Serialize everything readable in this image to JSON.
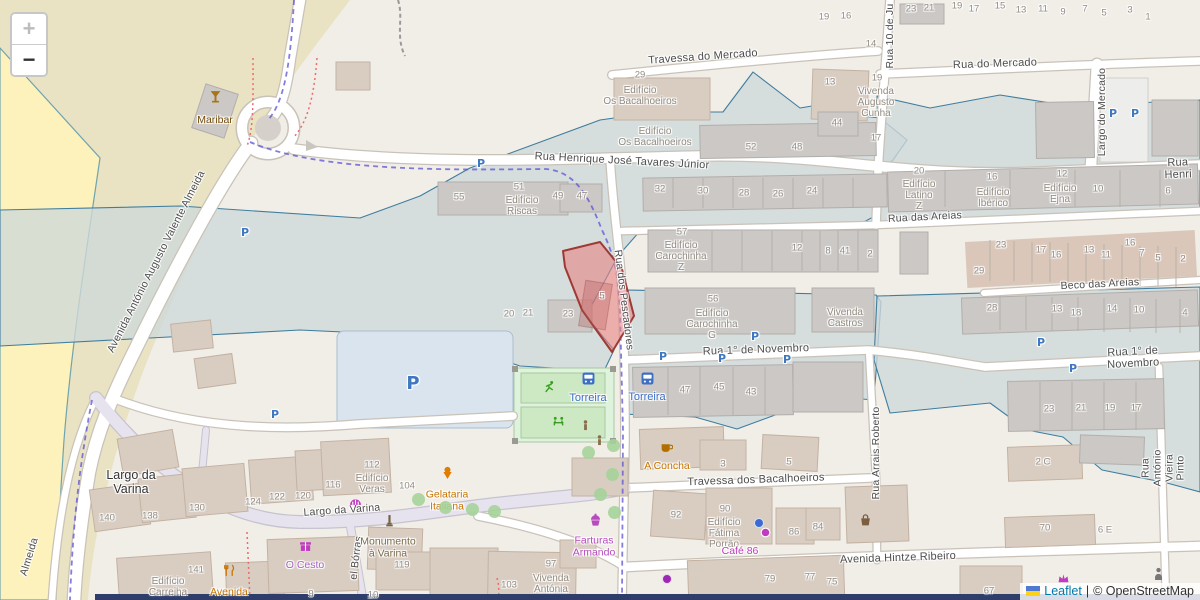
{
  "controls": {
    "zoom_in": "+",
    "zoom_out": "−"
  },
  "attribution": {
    "link": "Leaflet",
    "sep": "|",
    "copyright": "© OpenStreetMap"
  },
  "colors": {
    "zone_fill": "#ced8da",
    "zone_stroke": "#3f7d9e",
    "parcel_fill": "#e78686",
    "parcel_stroke": "#9e3a34",
    "boundary_dash": "#5b52d6",
    "route_dash": "#ef6a6a",
    "parking_blue": "#3f78c0",
    "bus_blue": "#3d6fc4",
    "poi_amber": "#c77400",
    "poi_magenta": "#c13ac1"
  },
  "selected_parcel": {
    "number": "5"
  },
  "streets": [
    {
      "t": "Travessa do Mercado",
      "x": 703,
      "y": 57,
      "r": -4,
      "s": 11
    },
    {
      "t": "Rua do Mercado",
      "x": 995,
      "y": 64,
      "r": -2,
      "s": 11
    },
    {
      "t": "Rua Henrique José Tavares Júnior",
      "x": 622,
      "y": 161,
      "r": 3,
      "s": 11
    },
    {
      "t": "Rua Henri",
      "x": 1178,
      "y": 169,
      "r": -2,
      "s": 11
    },
    {
      "t": "Rua das Areias",
      "x": 925,
      "y": 218,
      "r": -3,
      "s": 10.5
    },
    {
      "t": "Beco das Areias",
      "x": 1100,
      "y": 285,
      "r": -3,
      "s": 10.5
    },
    {
      "t": "Rua 1° de Novembro",
      "x": 756,
      "y": 350,
      "r": -2,
      "s": 11
    },
    {
      "t": "Rua 1° de Novembro",
      "x": 1133,
      "y": 358,
      "r": -3,
      "s": 11
    },
    {
      "t": "Travessa dos Bacalhoeiros",
      "x": 756,
      "y": 480,
      "r": -2,
      "s": 11
    },
    {
      "t": "Avenida Hintze Ribeiro",
      "x": 898,
      "y": 558,
      "r": -2,
      "s": 11
    },
    {
      "t": "Largo da Varina",
      "x": 342,
      "y": 511,
      "r": -4,
      "s": 10.5
    },
    {
      "t": "Rua dos Pescadores",
      "x": 623,
      "y": 300,
      "r": 83,
      "s": 10.5
    },
    {
      "t": "Rua 10 de Ju",
      "x": 891,
      "y": 36,
      "r": -90,
      "s": 10.5
    },
    {
      "t": "Largo do Mercado",
      "x": 1103,
      "y": 112,
      "r": -90,
      "s": 10.5
    },
    {
      "t": "Rua Arrais Roberto",
      "x": 877,
      "y": 453,
      "r": -90,
      "s": 10.5
    },
    {
      "t": "Rua António Vieira Pinto",
      "x": 1164,
      "y": 468,
      "r": -90,
      "s": 10.5
    },
    {
      "t": "Avenida António Augusto Valente Almeida",
      "x": 157,
      "y": 262,
      "r": -63,
      "s": 10.5
    },
    {
      "t": "Almeida",
      "x": 30,
      "y": 557,
      "r": -73,
      "s": 10.5
    },
    {
      "t": "el Bórras",
      "x": 357,
      "y": 558,
      "r": -83,
      "s": 10.5
    }
  ],
  "places": [
    {
      "t": "Largo da\nVarina",
      "x": 131,
      "y": 482
    }
  ],
  "building_labels": [
    {
      "t": "Edifício\nOs Bacalhoeiros",
      "x": 640,
      "y": 96
    },
    {
      "t": "Vivenda\nAugusto\nCunha",
      "x": 876,
      "y": 103
    },
    {
      "t": "Edifício\nOs Bacalhoeiros",
      "x": 655,
      "y": 137
    },
    {
      "t": "Edifício\nRiscas",
      "x": 522,
      "y": 206
    },
    {
      "t": "Edifício\nLatino\nZ",
      "x": 919,
      "y": 196
    },
    {
      "t": "Edifício\nIbérico",
      "x": 993,
      "y": 198
    },
    {
      "t": "Edifício\nEjna",
      "x": 1060,
      "y": 194
    },
    {
      "t": "Edifício\nCarochinha\nZ",
      "x": 681,
      "y": 257
    },
    {
      "t": "Edifício\nCarochinha\nG",
      "x": 712,
      "y": 325
    },
    {
      "t": "Vivenda\nCastros",
      "x": 845,
      "y": 318
    },
    {
      "t": "Edifício\nFátima\nPorrão",
      "x": 724,
      "y": 534
    },
    {
      "t": "Vivenda\nAntónia",
      "x": 551,
      "y": 584
    },
    {
      "t": "Edifício\nVeras",
      "x": 372,
      "y": 484
    },
    {
      "t": "Edifício\nCarreiha",
      "x": 168,
      "y": 587
    }
  ],
  "house_numbers": [
    {
      "t": "23",
      "x": 911,
      "y": 10
    },
    {
      "t": "21",
      "x": 929,
      "y": 9
    },
    {
      "t": "19",
      "x": 957,
      "y": 7
    },
    {
      "t": "17",
      "x": 974,
      "y": 10
    },
    {
      "t": "15",
      "x": 1000,
      "y": 7
    },
    {
      "t": "13",
      "x": 1021,
      "y": 11
    },
    {
      "t": "11",
      "x": 1043,
      "y": 10
    },
    {
      "t": "9",
      "x": 1063,
      "y": 13
    },
    {
      "t": "7",
      "x": 1085,
      "y": 10
    },
    {
      "t": "5",
      "x": 1104,
      "y": 14
    },
    {
      "t": "3",
      "x": 1130,
      "y": 11
    },
    {
      "t": "1",
      "x": 1148,
      "y": 18
    },
    {
      "t": "19",
      "x": 824,
      "y": 18
    },
    {
      "t": "16",
      "x": 846,
      "y": 17
    },
    {
      "t": "14",
      "x": 871,
      "y": 45
    },
    {
      "t": "29",
      "x": 640,
      "y": 76
    },
    {
      "t": "13",
      "x": 830,
      "y": 83
    },
    {
      "t": "19",
      "x": 877,
      "y": 79
    },
    {
      "t": "44",
      "x": 837,
      "y": 124
    },
    {
      "t": "52",
      "x": 751,
      "y": 148
    },
    {
      "t": "48",
      "x": 797,
      "y": 148
    },
    {
      "t": "17",
      "x": 876,
      "y": 139
    },
    {
      "t": "55",
      "x": 459,
      "y": 198
    },
    {
      "t": "51",
      "x": 519,
      "y": 188
    },
    {
      "t": "49",
      "x": 558,
      "y": 197
    },
    {
      "t": "47",
      "x": 582,
      "y": 197
    },
    {
      "t": "32",
      "x": 660,
      "y": 190
    },
    {
      "t": "30",
      "x": 703,
      "y": 192
    },
    {
      "t": "28",
      "x": 744,
      "y": 194
    },
    {
      "t": "26",
      "x": 778,
      "y": 195
    },
    {
      "t": "24",
      "x": 812,
      "y": 192
    },
    {
      "t": "20",
      "x": 919,
      "y": 172
    },
    {
      "t": "16",
      "x": 992,
      "y": 178
    },
    {
      "t": "12",
      "x": 1062,
      "y": 175
    },
    {
      "t": "10",
      "x": 1098,
      "y": 190
    },
    {
      "t": "6",
      "x": 1168,
      "y": 192
    },
    {
      "t": "57",
      "x": 682,
      "y": 233
    },
    {
      "t": "12",
      "x": 797,
      "y": 249
    },
    {
      "t": "8",
      "x": 828,
      "y": 252
    },
    {
      "t": "41",
      "x": 845,
      "y": 252
    },
    {
      "t": "2",
      "x": 870,
      "y": 255
    },
    {
      "t": "23",
      "x": 1001,
      "y": 246
    },
    {
      "t": "17",
      "x": 1041,
      "y": 251
    },
    {
      "t": "16",
      "x": 1056,
      "y": 256
    },
    {
      "t": "13",
      "x": 1089,
      "y": 251
    },
    {
      "t": "11",
      "x": 1106,
      "y": 256
    },
    {
      "t": "16",
      "x": 1130,
      "y": 244
    },
    {
      "t": "7",
      "x": 1142,
      "y": 254
    },
    {
      "t": "5",
      "x": 1158,
      "y": 259
    },
    {
      "t": "2",
      "x": 1183,
      "y": 260
    },
    {
      "t": "29",
      "x": 979,
      "y": 272
    },
    {
      "t": "28",
      "x": 992,
      "y": 309
    },
    {
      "t": "13",
      "x": 1057,
      "y": 310
    },
    {
      "t": "18",
      "x": 1076,
      "y": 314
    },
    {
      "t": "14",
      "x": 1112,
      "y": 310
    },
    {
      "t": "10",
      "x": 1139,
      "y": 311
    },
    {
      "t": "4",
      "x": 1185,
      "y": 314
    },
    {
      "t": "20",
      "x": 509,
      "y": 315
    },
    {
      "t": "21",
      "x": 528,
      "y": 314
    },
    {
      "t": "23",
      "x": 568,
      "y": 315
    },
    {
      "t": "5",
      "x": 602,
      "y": 297
    },
    {
      "t": "56",
      "x": 713,
      "y": 300
    },
    {
      "t": "47",
      "x": 685,
      "y": 391
    },
    {
      "t": "45",
      "x": 719,
      "y": 388
    },
    {
      "t": "43",
      "x": 751,
      "y": 393
    },
    {
      "t": "23",
      "x": 1049,
      "y": 410
    },
    {
      "t": "21",
      "x": 1081,
      "y": 409
    },
    {
      "t": "19",
      "x": 1110,
      "y": 409
    },
    {
      "t": "17",
      "x": 1136,
      "y": 409
    },
    {
      "t": "3",
      "x": 723,
      "y": 465
    },
    {
      "t": "5",
      "x": 789,
      "y": 463
    },
    {
      "t": "92",
      "x": 676,
      "y": 516
    },
    {
      "t": "90",
      "x": 725,
      "y": 510
    },
    {
      "t": "86",
      "x": 794,
      "y": 533
    },
    {
      "t": "84",
      "x": 818,
      "y": 528
    },
    {
      "t": "79",
      "x": 770,
      "y": 580
    },
    {
      "t": "77",
      "x": 810,
      "y": 578
    },
    {
      "t": "75",
      "x": 832,
      "y": 583
    },
    {
      "t": "70",
      "x": 1045,
      "y": 529
    },
    {
      "t": "67",
      "x": 989,
      "y": 592
    },
    {
      "t": "2 C",
      "x": 1043,
      "y": 463
    },
    {
      "t": "6 E",
      "x": 1105,
      "y": 531
    },
    {
      "t": "140",
      "x": 107,
      "y": 519
    },
    {
      "t": "138",
      "x": 150,
      "y": 517
    },
    {
      "t": "130",
      "x": 197,
      "y": 509
    },
    {
      "t": "124",
      "x": 253,
      "y": 503
    },
    {
      "t": "122",
      "x": 277,
      "y": 498
    },
    {
      "t": "120",
      "x": 303,
      "y": 497
    },
    {
      "t": "116",
      "x": 333,
      "y": 486
    },
    {
      "t": "104",
      "x": 407,
      "y": 487
    },
    {
      "t": "112",
      "x": 372,
      "y": 466
    },
    {
      "t": "141",
      "x": 196,
      "y": 571
    },
    {
      "t": "119",
      "x": 402,
      "y": 566
    },
    {
      "t": "103",
      "x": 509,
      "y": 586
    },
    {
      "t": "97",
      "x": 551,
      "y": 565
    },
    {
      "t": "9",
      "x": 311,
      "y": 595
    },
    {
      "t": "10",
      "x": 373,
      "y": 596
    }
  ],
  "pois": [
    {
      "icon": "cocktail-icon",
      "label": "Maribar",
      "ix": 215,
      "iy": 96,
      "lx": 215,
      "ly": 117,
      "icon_color": "#a8741a",
      "label_color": "#734a08"
    },
    {
      "icon": "cup-icon",
      "label": "A Concha",
      "ix": 666,
      "iy": 447,
      "lx": 667,
      "ly": 463,
      "icon_color": "#b06f00",
      "label_color": "#c77400"
    },
    {
      "icon": "gelato-icon",
      "label": "Gelataria\nItaliana",
      "ix": 447,
      "iy": 472,
      "lx": 447,
      "ly": 497,
      "icon_color": "#e07c00",
      "label_color": "#c77400"
    },
    {
      "icon": "restaurant-icon",
      "label": "Avenida",
      "ix": 229,
      "iy": 570,
      "lx": 229,
      "ly": 589,
      "icon_color": "#c77400",
      "label_color": "#c77400"
    },
    {
      "icon": "gift-icon",
      "label": "O Cesto",
      "ix": 305,
      "iy": 545,
      "lx": 305,
      "ly": 562,
      "icon_color": "#c13ac1",
      "label_color": "#aa62c8"
    },
    {
      "icon": "monument-icon",
      "label": "Monumento\nà Varina",
      "ix": 389,
      "iy": 520,
      "lx": 388,
      "ly": 544,
      "icon_color": "#75603f",
      "label_color": "#7c6a4a"
    },
    {
      "icon": "cupcake-icon",
      "label": "Farturas\nArmando",
      "ix": 595,
      "iy": 519,
      "lx": 594,
      "ly": 543,
      "icon_color": "#b84ac0",
      "label_color": "#b84ac0"
    },
    {
      "icon": "dot-icon",
      "label": "Café 86",
      "ix": 765,
      "iy": 532,
      "lx": 740,
      "ly": 548,
      "icon_color": "#c13ac1",
      "label_color": "#c13ac1"
    }
  ],
  "bus_stops": [
    {
      "label": "Torreira",
      "x": 588,
      "y": 378,
      "lx": 588,
      "ly": 395
    },
    {
      "label": "Torreira",
      "x": 647,
      "y": 378,
      "lx": 647,
      "ly": 394
    }
  ],
  "parking_marks": [
    {
      "x": 481,
      "y": 164
    },
    {
      "x": 245,
      "y": 233
    },
    {
      "x": 275,
      "y": 415
    },
    {
      "x": 663,
      "y": 357
    },
    {
      "x": 722,
      "y": 359
    },
    {
      "x": 787,
      "y": 360
    },
    {
      "x": 755,
      "y": 337
    },
    {
      "x": 1041,
      "y": 343
    },
    {
      "x": 1073,
      "y": 369
    },
    {
      "x": 1113,
      "y": 114
    },
    {
      "x": 1135,
      "y": 114
    },
    {
      "x": 413,
      "y": 384,
      "big": true
    }
  ],
  "misc_icons": [
    {
      "icon": "crown-icon",
      "x": 1063,
      "y": 578,
      "color": "#c13ac1"
    },
    {
      "icon": "person-icon",
      "x": 1158,
      "y": 573,
      "color": "#777777"
    },
    {
      "icon": "statue-icon",
      "x": 585,
      "y": 425,
      "color": "#8a6d4b"
    },
    {
      "icon": "statue-icon",
      "x": 599,
      "y": 440,
      "color": "#8a6d4b"
    },
    {
      "icon": "awning-icon",
      "x": 355,
      "y": 500,
      "color": "#c13ac1"
    },
    {
      "icon": "basket-icon",
      "x": 865,
      "y": 520,
      "color": "#7b5d3f"
    },
    {
      "icon": "playground-run-icon",
      "x": 549,
      "y": 386,
      "color": "#3a9d23"
    },
    {
      "icon": "playground-icon",
      "x": 558,
      "y": 420,
      "color": "#3a9d23"
    }
  ],
  "dots": [
    {
      "x": 758,
      "y": 522,
      "color": "#3b6ad4"
    },
    {
      "x": 666,
      "y": 578,
      "color": "#9c27b0"
    }
  ],
  "trees": [
    [
      613,
      445
    ],
    [
      588,
      452
    ],
    [
      612,
      474
    ],
    [
      600,
      494
    ],
    [
      614,
      512
    ],
    [
      418,
      499
    ],
    [
      445,
      507
    ],
    [
      472,
      509
    ],
    [
      494,
      511
    ]
  ]
}
